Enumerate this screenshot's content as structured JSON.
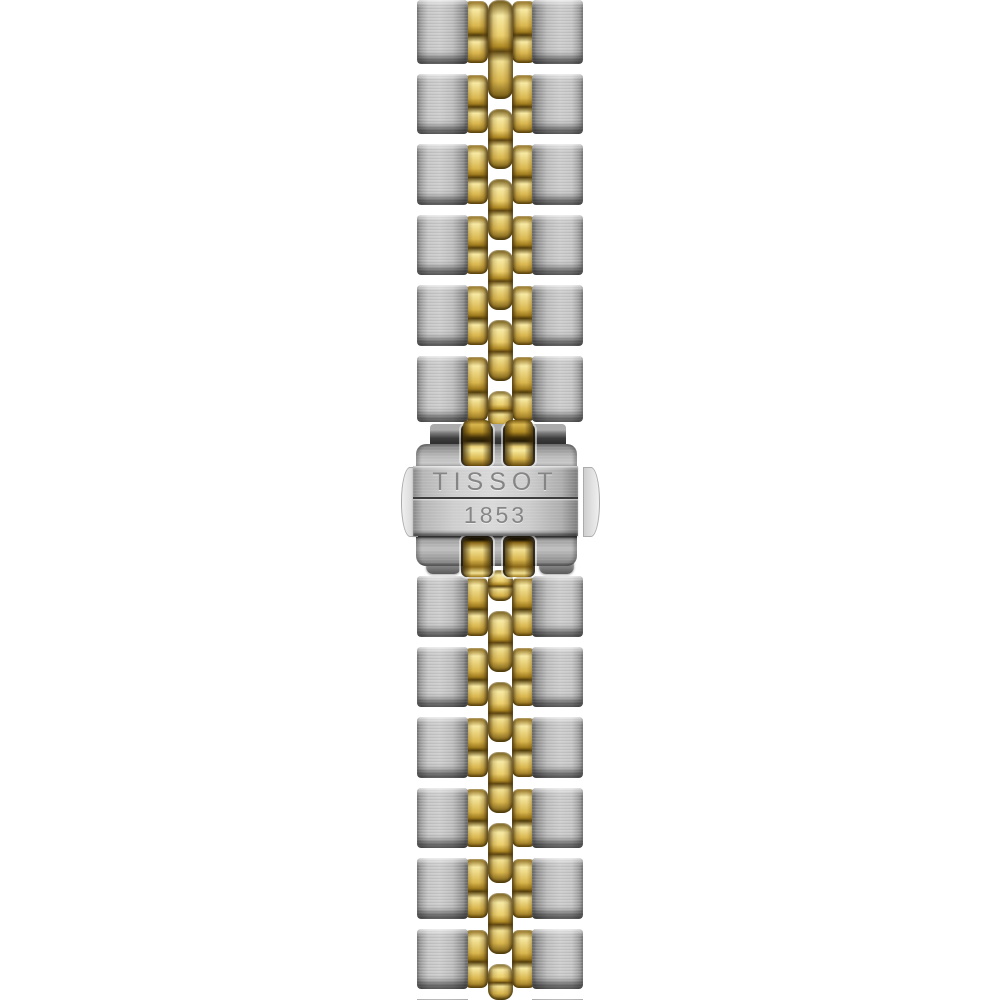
{
  "product": {
    "brand": "TISSOT",
    "year": "1853",
    "description": "Two-tone stainless steel and yellow gold five-link watch bracelet with engraved deployant clasp, photographed vertically on a white background"
  },
  "colors": {
    "background": "#ffffff",
    "steel_face": "#c7c7c7",
    "steel_edge": "#5a5a5a",
    "gold_highlight": "#f7e9a3",
    "gold_mid": "#d9b64e",
    "gold_dark": "#8a6817",
    "clasp_plate": "#cecece",
    "engraving_gray": "#858585",
    "seam_dark": "#3d3d3d"
  }
}
